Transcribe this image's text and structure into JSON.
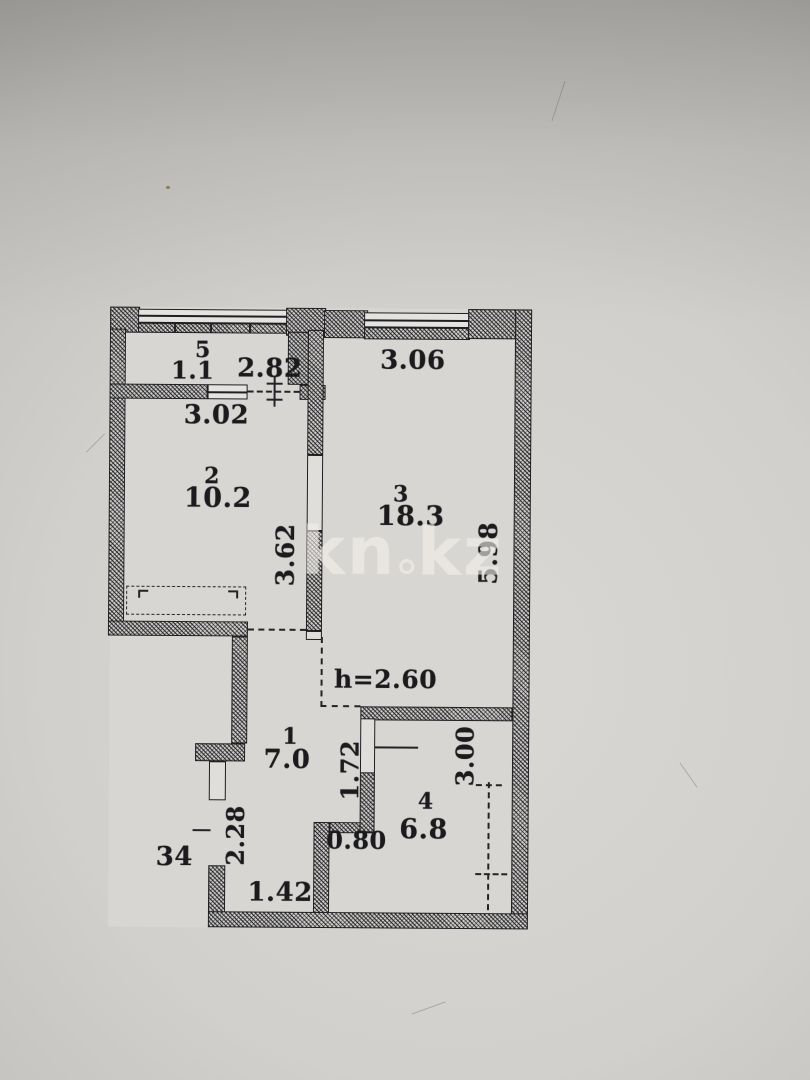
{
  "watermark": {
    "left": "kn",
    "right": "kz"
  },
  "plan": {
    "height_note": "h=2.60",
    "apartment_number": "34",
    "rooms": [
      {
        "number": "5",
        "area": "1.1"
      },
      {
        "number": "2",
        "area": "10.2"
      },
      {
        "number": "3",
        "area": "18.3"
      },
      {
        "number": "1",
        "area": "7.0"
      },
      {
        "number": "4",
        "area": "6.8"
      }
    ],
    "dimensions": {
      "balcony_width": "2.82",
      "room2_width": "3.02",
      "room2_depth": "3.62",
      "room3_width": "3.06",
      "room3_depth": "5.98",
      "hall_width": "1.72",
      "kitchen_door_width": "0.80",
      "kitchen_depth": "3.00",
      "entry_depth": "2.28",
      "entry_width": "1.42"
    },
    "colors": {
      "ink": "#1f1f22",
      "paper": "#cfcdc9"
    }
  }
}
